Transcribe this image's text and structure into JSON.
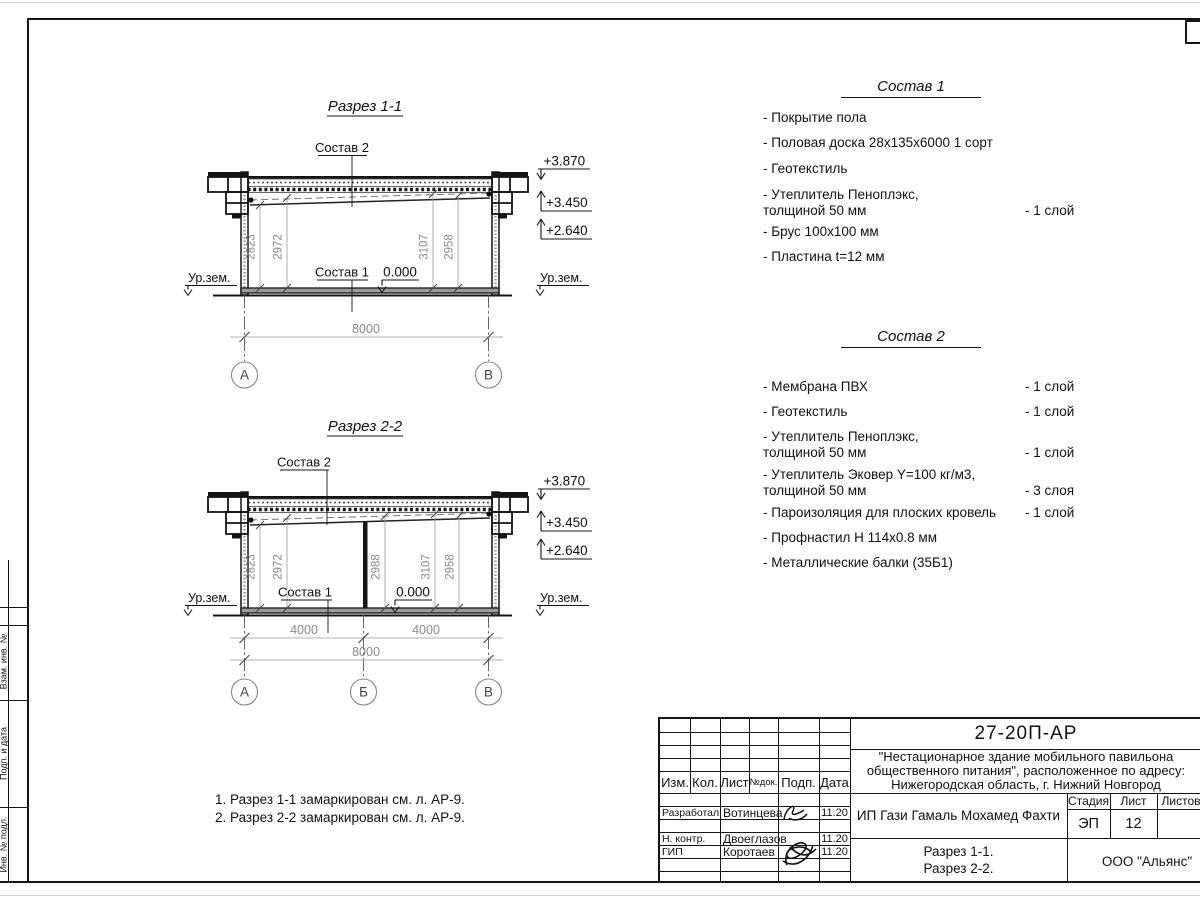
{
  "sheet": {
    "side_column_labels": [
      "Взам. инв. №",
      "Подп. и дата",
      "Инв. № подл."
    ]
  },
  "section1": {
    "title": "Разрез 1-1",
    "roof_label": "Состав 2",
    "floor_label": "Состав 1",
    "zero_level": "0.000",
    "ground_left": "Ур.зем.",
    "ground_right": "Ур.зем.",
    "elev_top": "+3.870",
    "elev_mid": "+3.450",
    "elev_low": "+2.640",
    "dim1": "2823",
    "dim2": "2972",
    "dim3": "3107",
    "dim4": "2958",
    "span_total": "8000",
    "axis_a": "А",
    "axis_b": "В"
  },
  "section2": {
    "title": "Разрез 2-2",
    "roof_label": "Состав 2",
    "floor_label": "Состав 1",
    "zero_level": "0.000",
    "ground_left": "Ур.зем.",
    "ground_right": "Ур.зем.",
    "elev_top": "+3.870",
    "elev_mid": "+3.450",
    "elev_low": "+2.640",
    "dim1": "2823",
    "dim2": "2972",
    "dim3": "2988",
    "dim4": "3107",
    "dim5": "2958",
    "span1": "4000",
    "span2": "4000",
    "span_total": "8000",
    "axis_a": "А",
    "axis_m": "Б",
    "axis_b": "В"
  },
  "spec1": {
    "title": "Состав 1",
    "items": [
      {
        "line1": "- Покрытие пола",
        "line2": "",
        "qty": ""
      },
      {
        "line1": "- Половая доска 28х135х6000 1 сорт",
        "line2": "",
        "qty": ""
      },
      {
        "line1": "- Геотекстиль",
        "line2": "",
        "qty": ""
      },
      {
        "line1": "- Утеплитель Пеноплэкс,",
        "line2": "толщиной 50 мм",
        "qty": "- 1 слой"
      },
      {
        "line1": "- Брус 100х100 мм",
        "line2": "",
        "qty": ""
      },
      {
        "line1": "- Пластина t=12 мм",
        "line2": "",
        "qty": ""
      }
    ]
  },
  "spec2": {
    "title": "Состав 2",
    "items": [
      {
        "line1": "- Мембрана ПВХ",
        "line2": "",
        "qty": "- 1 слой"
      },
      {
        "line1": "- Геотекстиль",
        "line2": "",
        "qty": "- 1 слой"
      },
      {
        "line1": "- Утеплитель Пеноплэкс,",
        "line2": "толщиной 50 мм",
        "qty": "- 1 слой"
      },
      {
        "line1": "- Утеплитель Эковер Y=100 кг/м3,",
        "line2": "толщиной 50 мм",
        "qty": "- 3 слоя"
      },
      {
        "line1": "- Пароизоляция для плоских кровель",
        "line2": "",
        "qty": "- 1 слой"
      },
      {
        "line1": "- Профнастил Н 114х0.8 мм",
        "line2": "",
        "qty": ""
      },
      {
        "line1": "- Металлические балки (35Б1)",
        "line2": "",
        "qty": ""
      }
    ]
  },
  "notes": {
    "line1": "1. Разрез 1-1 замаркирован см. л. АР-9.",
    "line2": "2. Разрез 2-2 замаркирован см. л. АР-9."
  },
  "titleblock": {
    "doc_number": "27-20П-АР",
    "project_line1": "\"Нестационарное здание мобильного павильона",
    "project_line2": "общественного питания\", расположенное по адресу:",
    "project_line3": "Нижегородская область, г. Нижний Новгород",
    "client": "ИП Гази Гамаль Мохамед Фахти",
    "sheet_title_line1": "Разрез 1-1.",
    "sheet_title_line2": "Разрез 2-2.",
    "organization": "ООО \"Альянс\"",
    "stage_label": "Стадия",
    "sheet_label": "Лист",
    "sheets_label": "Листов",
    "stage_value": "ЭП",
    "sheet_value": "12",
    "sheets_value": "",
    "col_izm": "Изм.",
    "col_kol": "Кол.",
    "col_list": "Лист",
    "col_doc": "№док.",
    "col_sign": "Подп.",
    "col_date": "Дата",
    "row1_role": "Разработал",
    "row1_name": "Вотинцева",
    "row1_date": "11.20",
    "row2_role": "Н. контр.",
    "row2_name": "Двоеглазов",
    "row2_date": "11.20",
    "row3_role": "ГИП",
    "row3_name": "Коротаев",
    "row3_date": "11.20"
  }
}
